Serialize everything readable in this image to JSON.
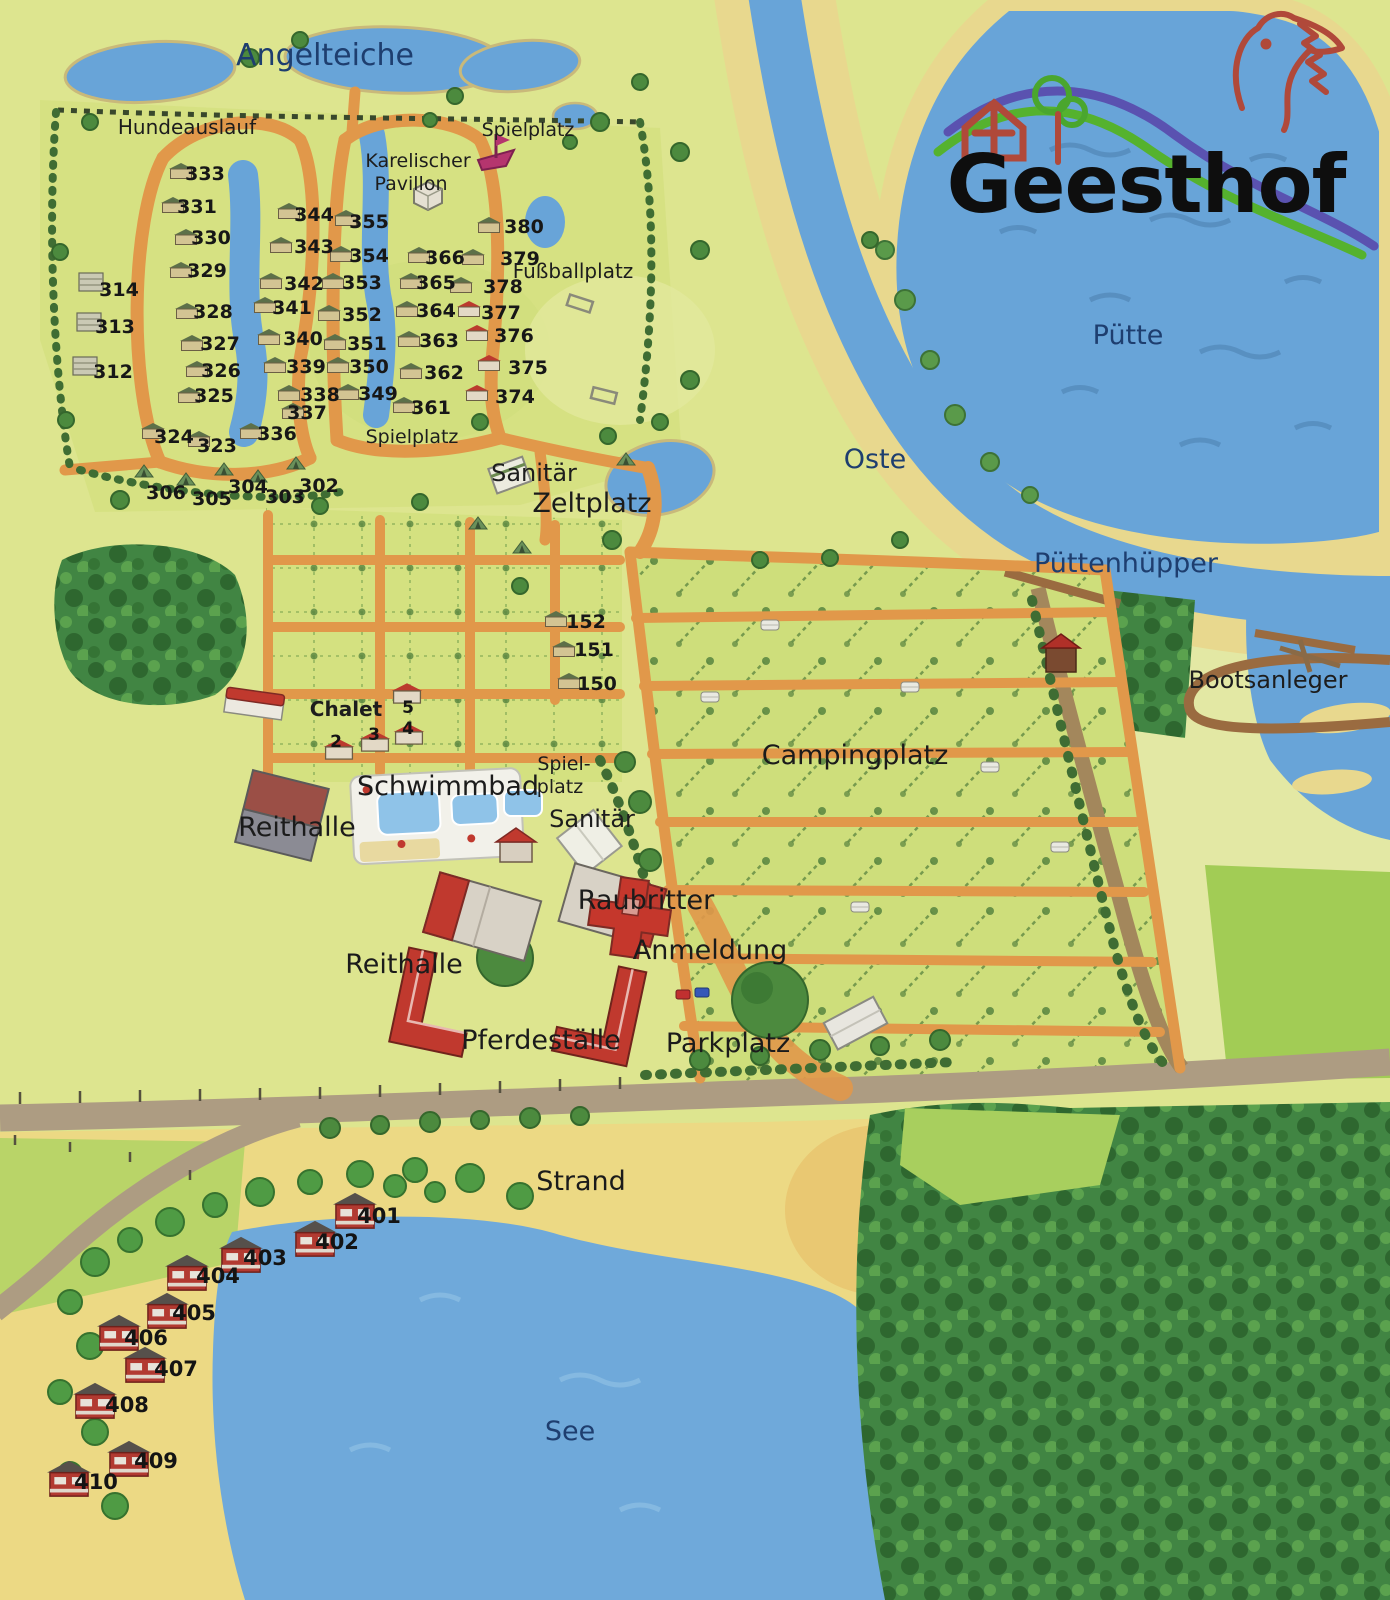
{
  "brand": "Geesthof",
  "palette": {
    "land": "#dde58f",
    "water": "#68a4d8",
    "sand": "#e9d88b",
    "beach": "#ecd984",
    "path_orange": "#e1984a",
    "road": "#ad9c82",
    "road_brown": "#a3875c",
    "forest": "#418543",
    "field_green": "#a2cc55",
    "building_red": "#c0392e",
    "label_blue": "#1e3e6f"
  },
  "water_labels": {
    "angelteiche": "Angelteiche",
    "oste": "Oste",
    "puette": "Pütte",
    "puettenhuepper": "Püttenhüpper",
    "see": "See"
  },
  "place_labels": {
    "hundeauslauf": "Hundeauslauf",
    "spielplatz_top": "Spielplatz",
    "karelischer_line1": "Karelischer",
    "karelischer_line2": "Pavillon",
    "fussballplatz": "Fußballplatz",
    "spielplatz_mid": "Spielplatz",
    "sanitaer_zeltplatz": "Sanitär",
    "zeltplatz": "Zeltplatz",
    "bootsanleger": "Bootsanleger",
    "chalet": "Chalet",
    "schwimmbad": "Schwimmbad",
    "spielplatz_line1": "Spiel-",
    "spielplatz_line2": "platz",
    "sanitaer_camping": "Sanitär",
    "reithalle_nord": "Reithalle",
    "raubritter": "Raubritter",
    "anmeldung": "Anmeldung",
    "reithalle_sued": "Reithalle",
    "pferdestaelle": "Pferdeställe",
    "parkplatz": "Parkplatz",
    "campingplatz": "Campingplatz",
    "strand": "Strand"
  },
  "sites": {
    "2": "2",
    "3": "3",
    "4": "4",
    "5": "5",
    "150": "150",
    "151": "151",
    "152": "152",
    "302": "302",
    "303": "303",
    "304": "304",
    "305": "305",
    "306": "306",
    "312": "312",
    "313": "313",
    "314": "314",
    "323": "323",
    "324": "324",
    "325": "325",
    "326": "326",
    "327": "327",
    "328": "328",
    "329": "329",
    "330": "330",
    "331": "331",
    "333": "333",
    "336": "336",
    "337": "337",
    "338": "338",
    "339": "339",
    "340": "340",
    "341": "341",
    "342": "342",
    "343": "343",
    "344": "344",
    "349": "349",
    "350": "350",
    "351": "351",
    "352": "352",
    "353": "353",
    "354": "354",
    "355": "355",
    "361": "361",
    "362": "362",
    "363": "363",
    "364": "364",
    "365": "365",
    "366": "366",
    "374": "374",
    "375": "375",
    "376": "376",
    "377": "377",
    "378": "378",
    "379": "379",
    "380": "380",
    "401": "401",
    "402": "402",
    "403": "403",
    "404": "404",
    "405": "405",
    "406": "406",
    "407": "407",
    "408": "408",
    "409": "409",
    "410": "410"
  }
}
